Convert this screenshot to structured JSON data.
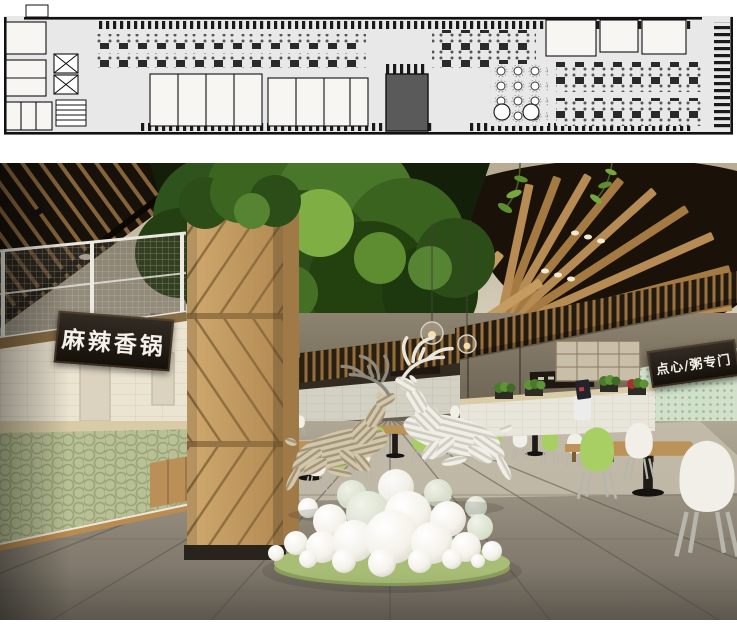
{
  "page": {
    "title": "Food court design presentation",
    "background_color": "#ffffff",
    "sections": [
      "floor-plan-drawing",
      "interior-render"
    ]
  },
  "floor_plan": {
    "label": "food-court-floor-plan",
    "background_color": "#e8e8e8",
    "wall_color": "#111111",
    "feature_block_color": "#5a5a5a",
    "zones": [
      "booth-seating-rows",
      "dining-table-rows",
      "kitchen-rooms",
      "elevators",
      "stairs",
      "round-table-hall",
      "feature-column-block"
    ]
  },
  "render": {
    "label": "food-court-interior-render",
    "signs": {
      "left_stall": "麻辣香锅",
      "right_stall": "点心/粥专门"
    },
    "features": [
      "wood-chevron-column",
      "tree-canopy",
      "radial-wood-ceiling-fins",
      "sliced-deer-sculptures",
      "white-sphere-cluster",
      "mesh-mezzanine-railing",
      "green-scallop-tile-counter",
      "green-dot-tile-wall",
      "pendant-lamps",
      "pos-terminal",
      "green-and-white-shell-chairs",
      "gray-marble-floor"
    ],
    "palette": {
      "ceiling": "#d8d1bd",
      "dark_ceiling": "#1a1208",
      "wood_slat": "#ab7f49",
      "column_wood": "#c29a64",
      "foliage": "#3c661f",
      "counter_tile": "#b9c096",
      "wall_tile": "#ebe4d1",
      "right_tile": "#d2e0cb",
      "floor": "#8d867a",
      "chair_green": "#a7cf63",
      "chair_white": "#f1efe8",
      "deer_tan": "#d3c7ab",
      "deer_white": "#f0eee6",
      "sphere_white": "#f6f4ee",
      "base_green": "#a8be76",
      "sign_bg": "#1d150d",
      "sign_text": "#f4f1e8"
    }
  }
}
